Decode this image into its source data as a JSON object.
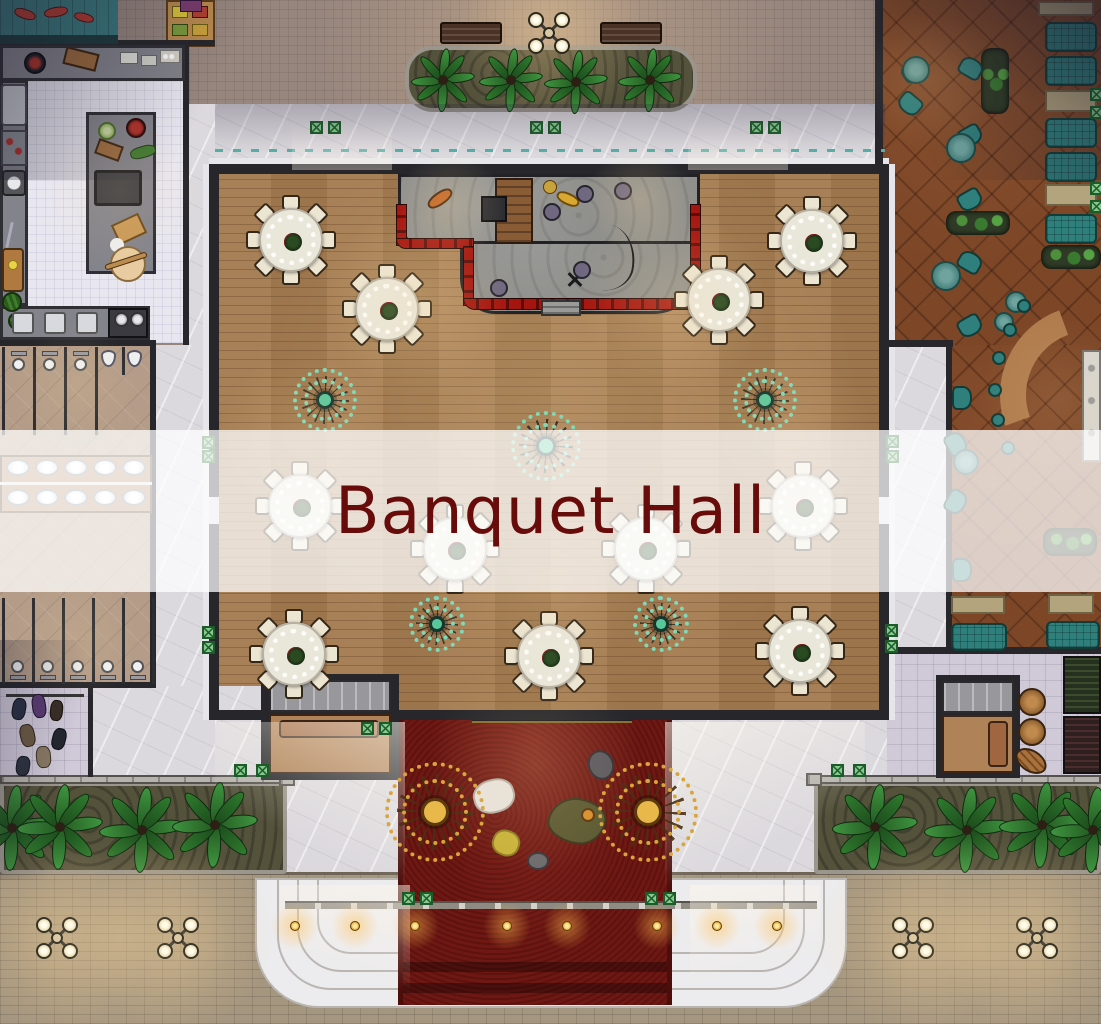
{
  "banner": {
    "title": "Banquet Hall"
  },
  "colors": {
    "banner_overlay": "rgba(255,255,255,0.74)",
    "banner_text": "#680b0b",
    "hall_wood": "#a47b50",
    "stage_floor": "#8f8f8c",
    "stage_trim_red": "#9c1712",
    "red_carpet": "#6f1712",
    "marble": "#dcd9de",
    "patio_floor": "#7c4627",
    "teal_furniture": "#2f7f7c",
    "kitchen_tile": "#e8e6ef",
    "bathroom_tile": "#b49c88",
    "counter_gray": "#83838b",
    "pavement": "#a5967f",
    "planter_soil": "#55523c",
    "palm_green": "#3f9440",
    "wall_dark": "#26262b",
    "lamp_globe": "#f3ead0",
    "gold": "#d9a43c",
    "tablecloth": "#e9e6da",
    "chair_cream": "#ece5d2",
    "medallion_teal": "#7fd9b8"
  },
  "icons": {
    "street-lamp": "four-globe-lamp-post",
    "banquet-table": "round-table-with-8-chairs",
    "chandelier-medallion": "radial-spoke-medallion-teal",
    "gold-medallion": "radial-spoke-medallion-gold",
    "palm-tree": "palm-top-view",
    "sun-lounger": "lounger-top-view",
    "armchair": "armchair-top-view",
    "toilet": "toilet-top-view",
    "urinal": "urinal-top-view",
    "sink": "oval-basin",
    "stage": "stage-with-red-curtain-trim",
    "red-carpet": "entrance-carpet-runner",
    "steps": "curved-entrance-steps",
    "railing": "entrance-railing",
    "coat-rack": "hanging-coats",
    "elevator": "elevator-car-with-sofa",
    "stairs": "staircase-top-view",
    "barrel": "barrel-top-view",
    "wine-rack": "bottle-rack",
    "bench": "bench-top-view",
    "planter": "garden-planter-bed",
    "side-table": "green-folding-table",
    "bar-counter": "curved-wooden-bar",
    "sofa": "lobby-sofa",
    "speaker": "stage-speaker",
    "guitar": "guitar",
    "saxophone": "saxophone",
    "mic-stand": "microphone-stand"
  },
  "counts": {
    "banquet_tables": 11,
    "chairs_per_table": 8,
    "hall_medallions": 5,
    "entrance_medallions": 2,
    "street_lamps": 5,
    "sun_loungers": 7,
    "toilets_top_row": 3,
    "urinals": 2,
    "toilets_bottom_row": 5,
    "sinks": 10,
    "step_lanterns": 8
  }
}
